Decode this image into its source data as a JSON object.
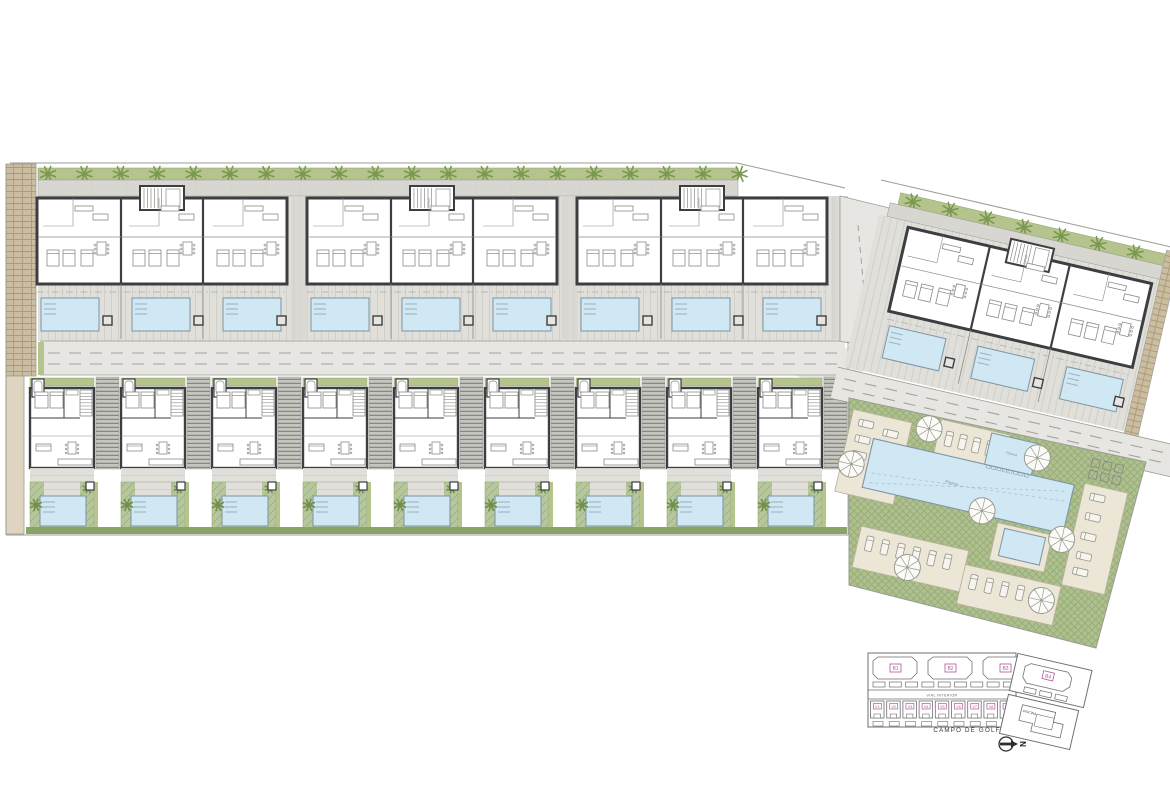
{
  "labels": {
    "golf": "CAMPO DE GOLF",
    "street": "VIAL INTERIOR",
    "pool_area": "PISCINA",
    "north": "N",
    "main_pool": "Piscina",
    "small_pool": "Piscina"
  },
  "key_plan": {
    "blocks": [
      "B1",
      "B2",
      "B3"
    ],
    "rotated_block": "B4",
    "villas": [
      "V1",
      "V2",
      "V3",
      "V4",
      "V5",
      "V6",
      "V7",
      "V8",
      "V9"
    ]
  },
  "site": {
    "apartment_blocks": 3,
    "rotated_blocks": 1,
    "pools_per_block": 3,
    "villas": 9,
    "communal_parasols": 7,
    "street_trees_top": 20,
    "street_trees_rotated": 8
  },
  "colors": {
    "paper": "#ffffff",
    "wall": "#3d3e42",
    "thin": "#8a8a86",
    "boundary": "#9b9b95",
    "terrace": "#e0dfda",
    "terrace_line": "#d0cfc9",
    "sidewalk": "#d7d6d1",
    "road": "#e7e6e2",
    "road_dash": "#a3a39d",
    "hedge": "#b4c48c",
    "hedge_dark": "#8aa468",
    "tree": "#7b9851",
    "palm": "#6f8f4a",
    "lawn": "#b7c79d",
    "lawn_line": "#9cb27e",
    "lawn2": "#aec08f",
    "lawn2_line": "#97ac73",
    "pool": "#cfe8f4",
    "pool_line": "#7e95a3",
    "pool_step": "#9fb6c2",
    "stone": "#cbbda2",
    "stone_line": "#a8976f",
    "stone_light": "#ded4c0",
    "stair_bg": "#c6c5c0",
    "stair_line": "#79786f",
    "deck_tan": "#ece6d6",
    "deck_tan_line": "#b9b19c",
    "kline": "#6f6f6f",
    "magenta": "#b2569f",
    "text_dark": "#3c3c3c"
  }
}
